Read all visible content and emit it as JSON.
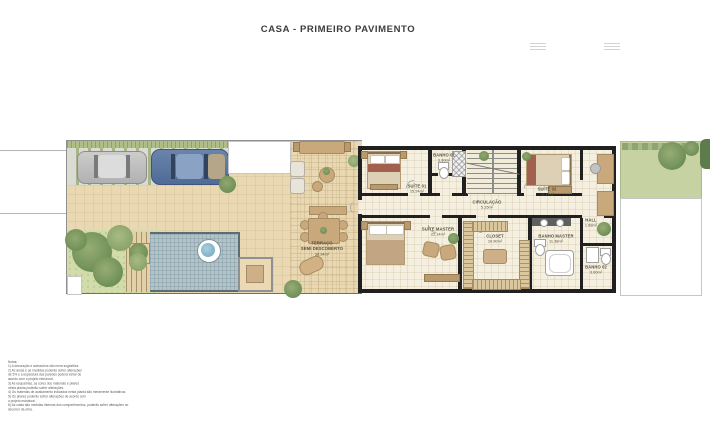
{
  "title": "CASA - PRIMEIRO PAVIMENTO",
  "rooms": [
    {
      "id": "terraco",
      "name": "TERRAÇO",
      "name2": "SEMI DESCOBERTO",
      "area": "36.34m²"
    },
    {
      "id": "suite-01",
      "name": "SUÍTE 01",
      "area": "15.24m²"
    },
    {
      "id": "banho-01",
      "name": "BANHO 01",
      "area": "3.30m²"
    },
    {
      "id": "suite-02",
      "name": "SUÍTE 02",
      "area": "15.41m²"
    },
    {
      "id": "circulacao",
      "name": "CIRCULAÇÃO",
      "area": "5.15m²"
    },
    {
      "id": "suite-master",
      "name": "SUÍTE MASTER",
      "area": "22.14m²"
    },
    {
      "id": "closet",
      "name": "CLOSET",
      "area": "10.90m²"
    },
    {
      "id": "banho-master",
      "name": "BANHO MASTER",
      "area": "11.38m²"
    },
    {
      "id": "hall",
      "name": "HALL",
      "area": "1.68m²"
    },
    {
      "id": "banho-02",
      "name": "BANHO 02",
      "area": "3.60m²"
    }
  ],
  "notes": {
    "heading": "Notas:",
    "lines": [
      "1) A decoração e acessórios são mera sugestões.",
      "2) As áreas e as medidas poderão sofrer alterações",
      "de 5% e a espessura das paredes poderá variar de",
      "acordo com o projeto estrutural.",
      "3) As esquadrias, as cores dos materiais e pilares",
      "nesta planta poderão sofrer alterações.",
      "4) Os materiais de acabamento indicados nesta planta são meramente ilustrativos.",
      "5) Os pilares poderão sofrer alterações de acordo com",
      "o projeto estrutural.",
      "6) As cotas são medidas internas dos compartimentos, poderão sofrer alterações no",
      "decorrer da obra."
    ]
  },
  "colors": {
    "wall": "#202020",
    "outdoor_floor": "#e9d8b2",
    "indoor_floor": "#f5efdf",
    "pool_water": "#b2c3ca",
    "grass": "#aebf85",
    "garden": "#d2dcab",
    "wood_furniture": "#c9a97c"
  }
}
